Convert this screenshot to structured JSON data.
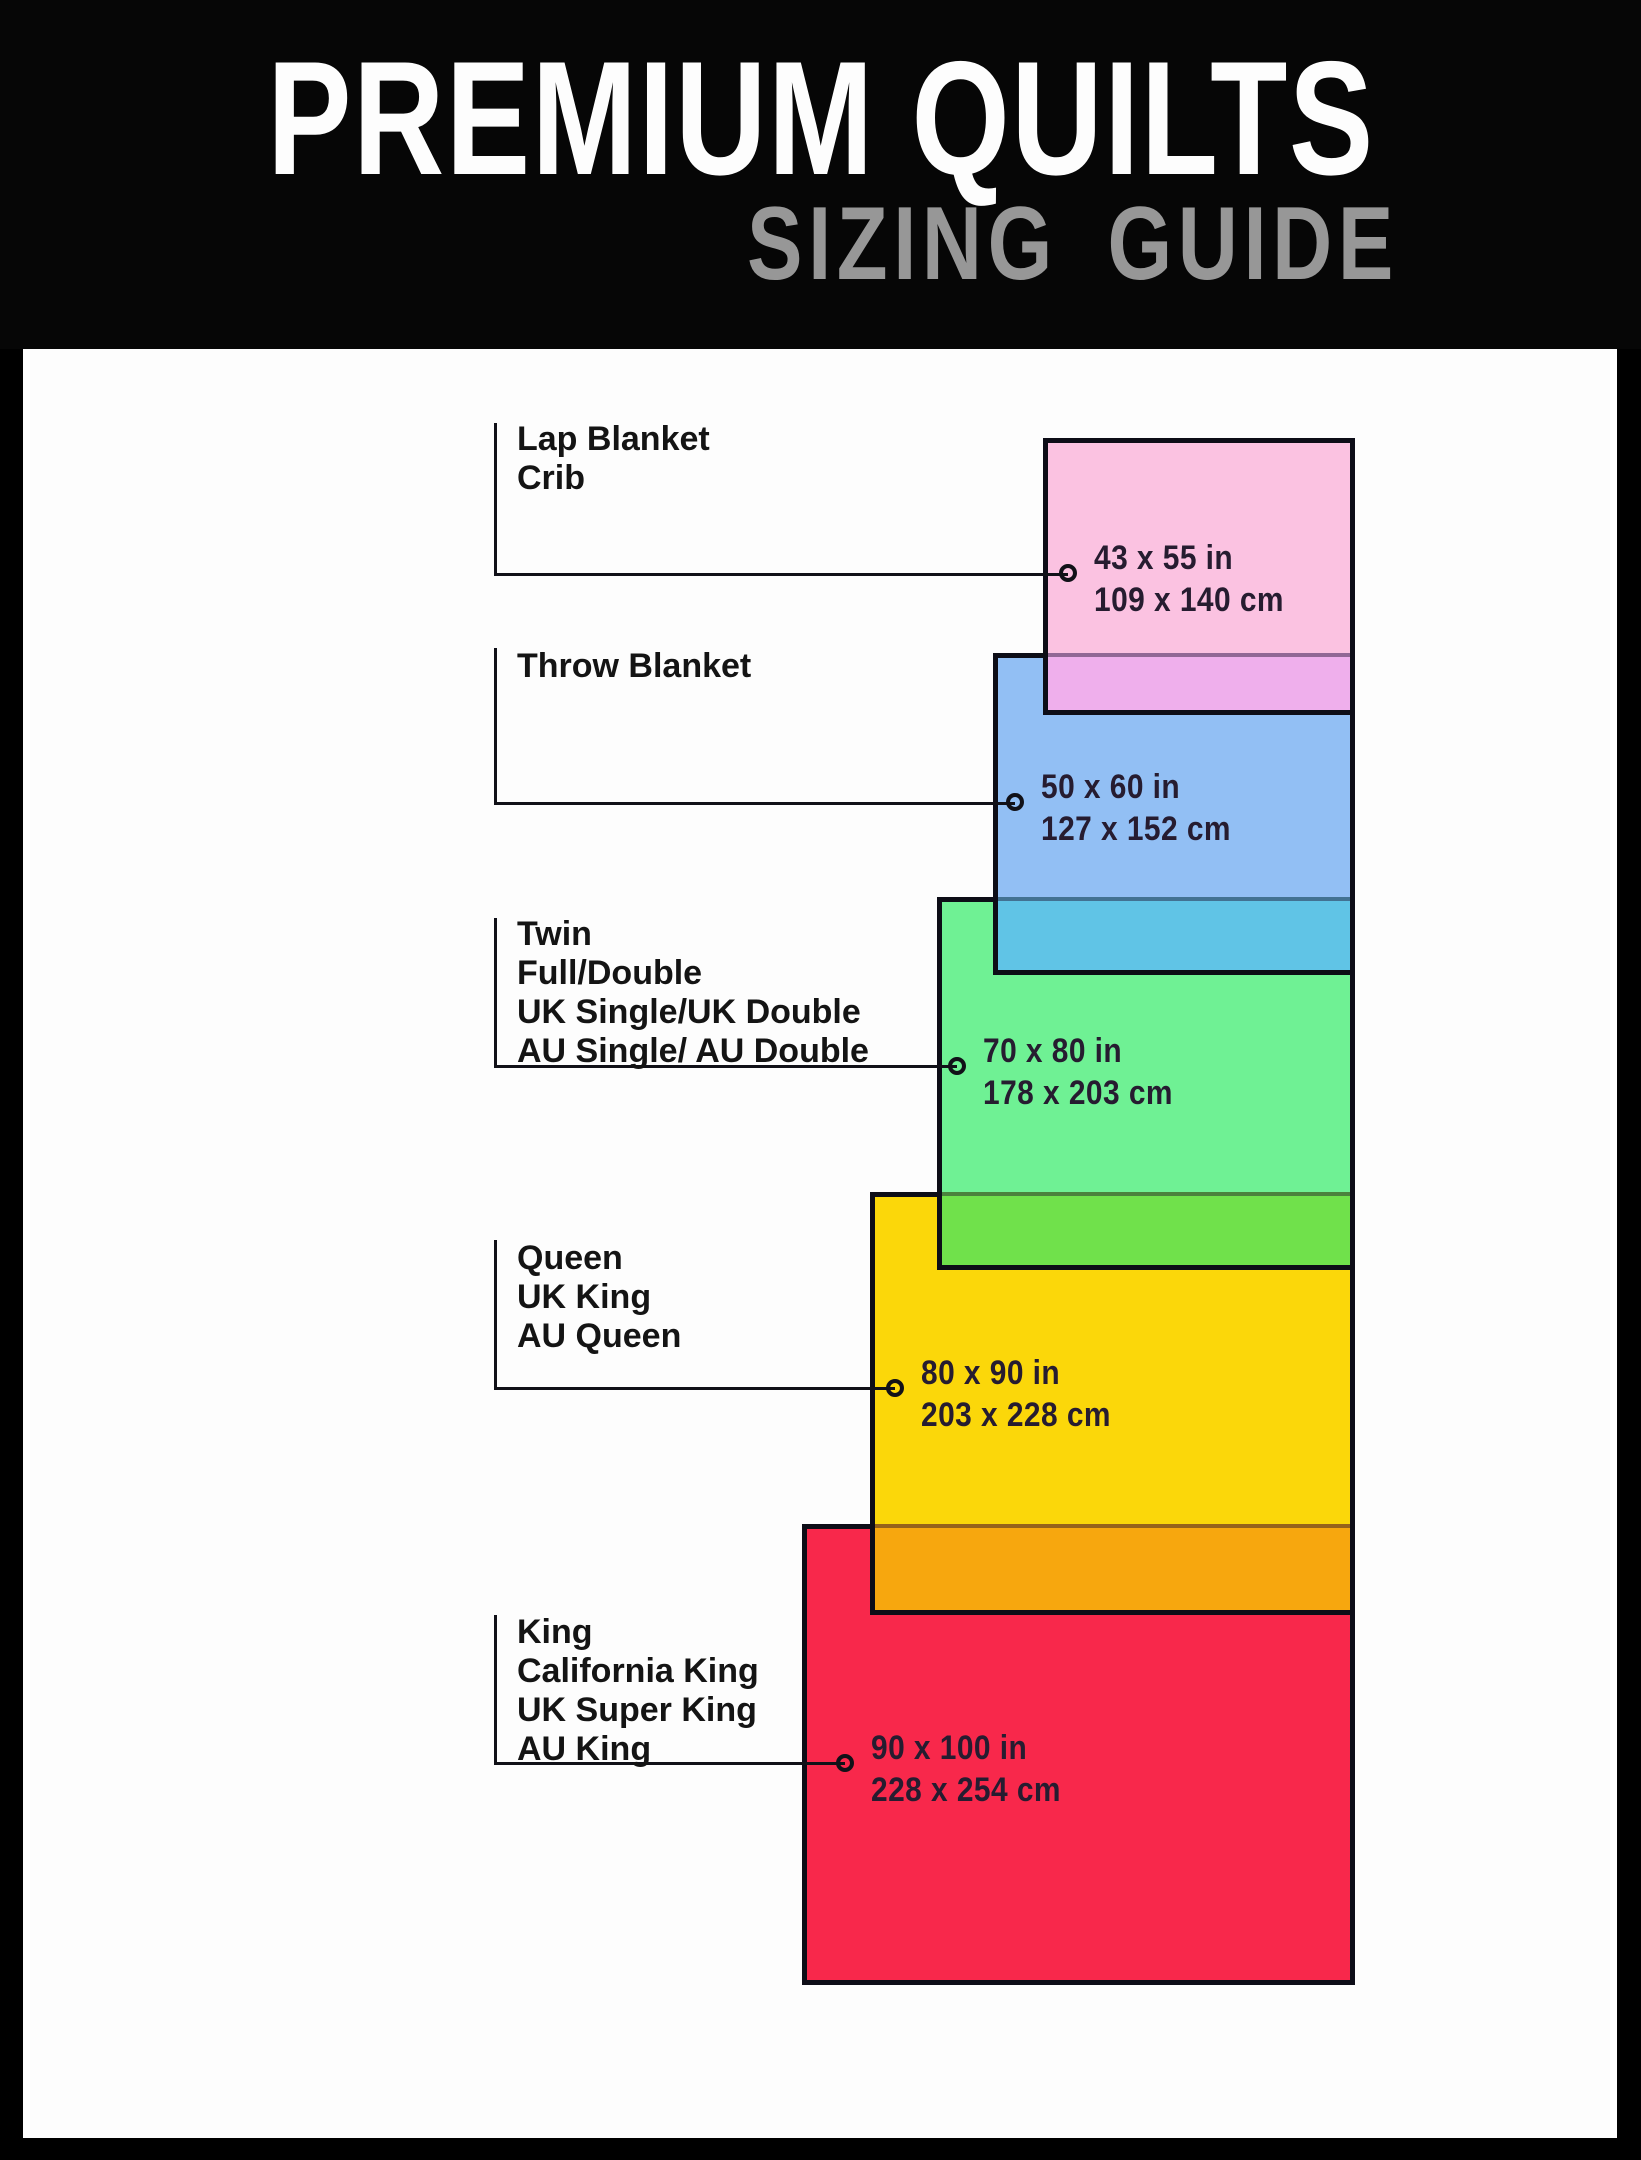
{
  "header": {
    "title": "PREMIUM QUILTS",
    "subtitle": "SIZING GUIDE"
  },
  "colors": {
    "background": "#060606",
    "panel": "#fdfdfd",
    "border": "#0d0d17",
    "subtitle_gray": "#979797",
    "lap_pink": "#fbc2e1",
    "lap_over_throw_purple": "#efafec",
    "throw_blue": "#92bff4",
    "throw_over_twin_teal": "#60c4e6",
    "twin_green": "#6ff194",
    "twin_over_queen_yellowgreen": "#70e14b",
    "queen_yellow": "#fbd70a",
    "queen_over_king_orange": "#f7a70e",
    "king_red": "#f8284b"
  },
  "sizes": [
    {
      "id": "lap-blanket-crib",
      "names": [
        "Lap Blanket",
        "Crib"
      ],
      "inches": "43 x 55 in",
      "cm": "109 x 140 cm"
    },
    {
      "id": "throw-blanket",
      "names": [
        "Throw Blanket"
      ],
      "inches": "50 x 60 in",
      "cm": "127 x 152 cm"
    },
    {
      "id": "twin",
      "names": [
        "Twin",
        "Full/Double",
        "UK Single/UK Double",
        "AU Single/ AU Double"
      ],
      "inches": "70 x 80 in",
      "cm": "178 x 203 cm"
    },
    {
      "id": "queen",
      "names": [
        "Queen",
        "UK King",
        "AU Queen"
      ],
      "inches": "80 x 90 in",
      "cm": "203 x 228 cm"
    },
    {
      "id": "king",
      "names": [
        "King",
        "California King",
        "UK Super King",
        "AU King"
      ],
      "inches": "90 x 100 in",
      "cm": "228 x 254 cm"
    }
  ]
}
